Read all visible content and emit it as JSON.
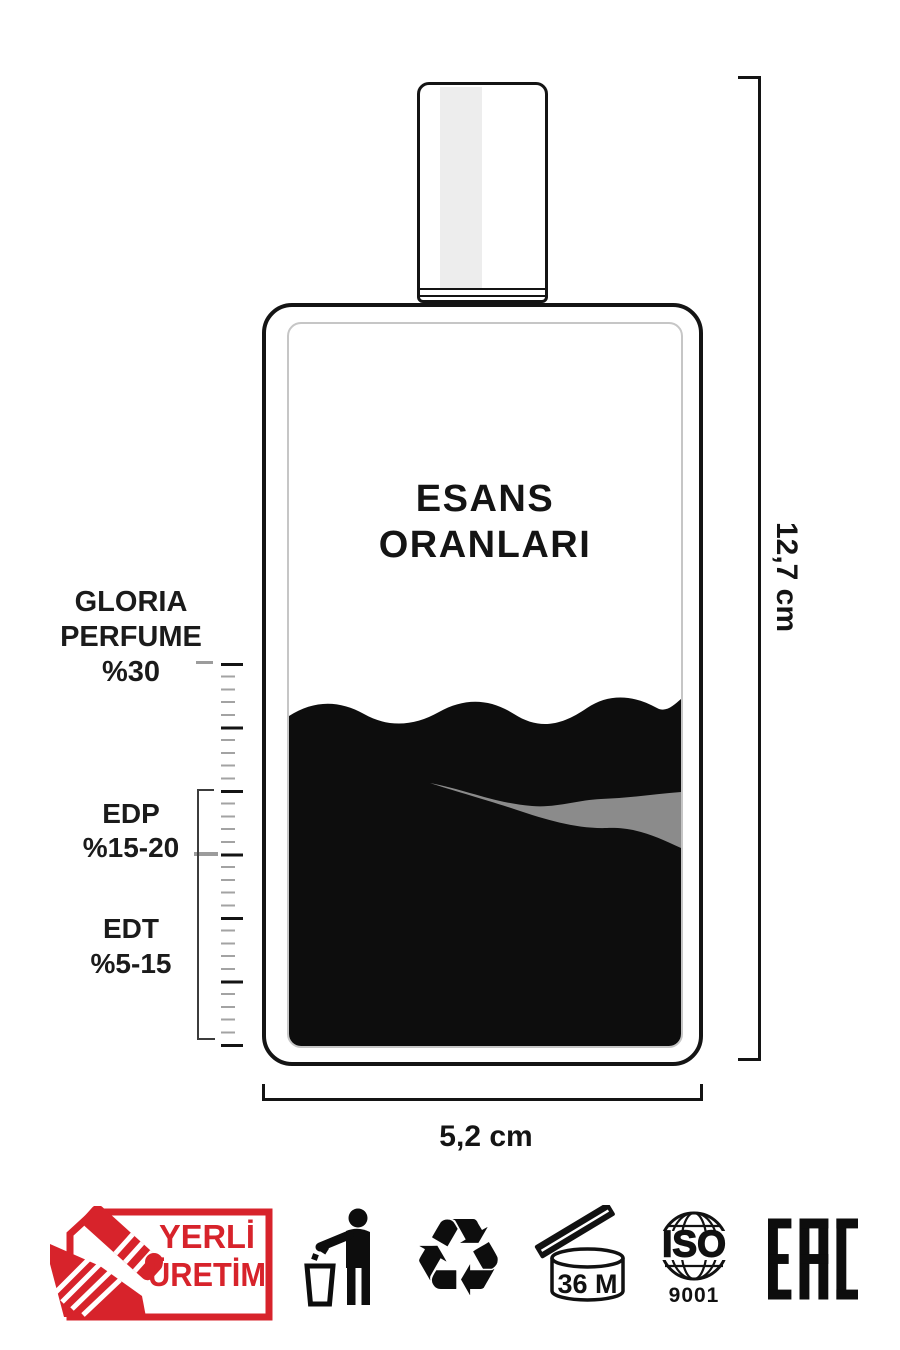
{
  "bottle": {
    "title_line1": "ESANS",
    "title_line2": "ORANLARI"
  },
  "scale": {
    "gloria": {
      "l1": "GLORIA",
      "l2": "PERFUME",
      "l3": "%30"
    },
    "edp": {
      "l1": "EDP",
      "l2": "%15-20"
    },
    "edt": {
      "l1": "EDT",
      "l2": "%5-15"
    }
  },
  "dimensions": {
    "height_label": "12,7 cm",
    "width_label": "5,2 cm"
  },
  "badge_yerli": {
    "line1": "YERLİ",
    "line2": "ÜRETİM"
  },
  "pao": {
    "label": "36 M"
  },
  "iso": {
    "name": "ISO",
    "number": "9001"
  },
  "eac": {
    "label": "EAC"
  },
  "icons": {
    "recycle_glyph": "♻",
    "names": [
      "handshake-icon",
      "tidy-man-icon",
      "recycle-icon",
      "open-jar-icon",
      "globe-icon",
      "eac-mark"
    ]
  },
  "colors": {
    "accent_red": "#d7232b",
    "ink_black": "#141414",
    "liquid_black": "#0d0d0d",
    "streak_gray": "#8b8b8b",
    "ruler_gray": "#9c9c9c"
  }
}
